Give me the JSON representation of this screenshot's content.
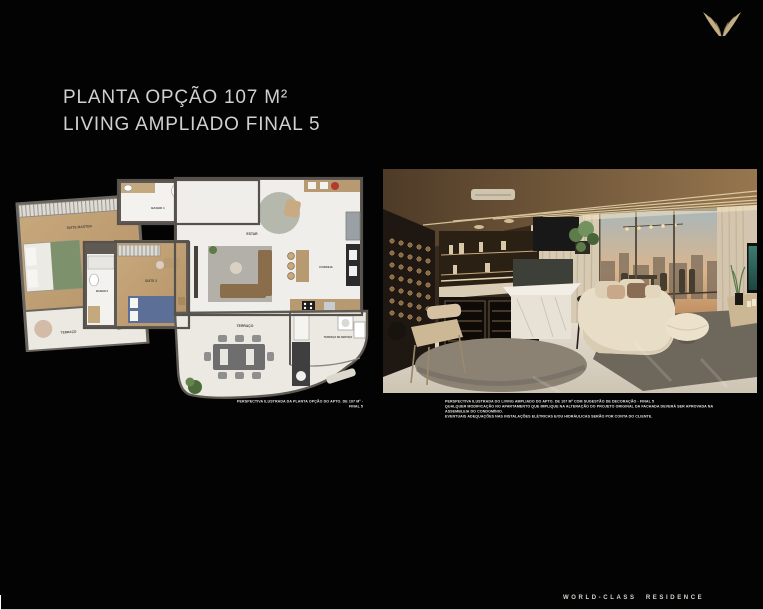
{
  "page": {
    "title_line1": "PLANTA OPÇÃO 107 M²",
    "title_line2": "LIVING AMPLIADO FINAL 5",
    "footer_text": "WORLD-CLASS RESIDENCE",
    "background": "#030303"
  },
  "brand": {
    "logo": "wings-logo",
    "accent_gold": "#c3ae84"
  },
  "floor_plan": {
    "caption": "PERSPECTIVA ILUSTRADA DA PLANTA OPÇÃO DO APTO. DE 107 M² - FINAL 5",
    "rooms": [
      {
        "label": "SUITE MASTER"
      },
      {
        "label": "BANHO 1"
      },
      {
        "label": "LAVABO"
      },
      {
        "label": "ESTAR"
      },
      {
        "label": "COZINHA"
      },
      {
        "label": "BANHO 2"
      },
      {
        "label": "SUITE 2"
      },
      {
        "label": "TERRAÇO"
      },
      {
        "label": "TERRAÇO"
      },
      {
        "label": "TERRAÇO DE SERVIÇO"
      }
    ]
  },
  "photo": {
    "description": "living-room-render",
    "captions": [
      "PERSPECTIVA ILUSTRADA DO LIVING AMPLIADO DO APTO. DE 107 M² COM SUGESTÃO DE DECORAÇÃO - FINAL 5",
      "QUALQUER MODIFICAÇÃO NO APARTAMENTO QUE IMPLIQUE NA ALTERAÇÃO DO PROJETO ORIGINAL DA FACHADA DEVERÁ SER APROVADA NA ASSEMBLEIA DO CONDOMÍNIO.",
      "EVENTUAIS ADEQUAÇÕES NAS INSTALAÇÕES ELÉTRICAS E/OU HIDRÁULICAS SERÃO POR CONTA DO CLIENTE."
    ]
  }
}
